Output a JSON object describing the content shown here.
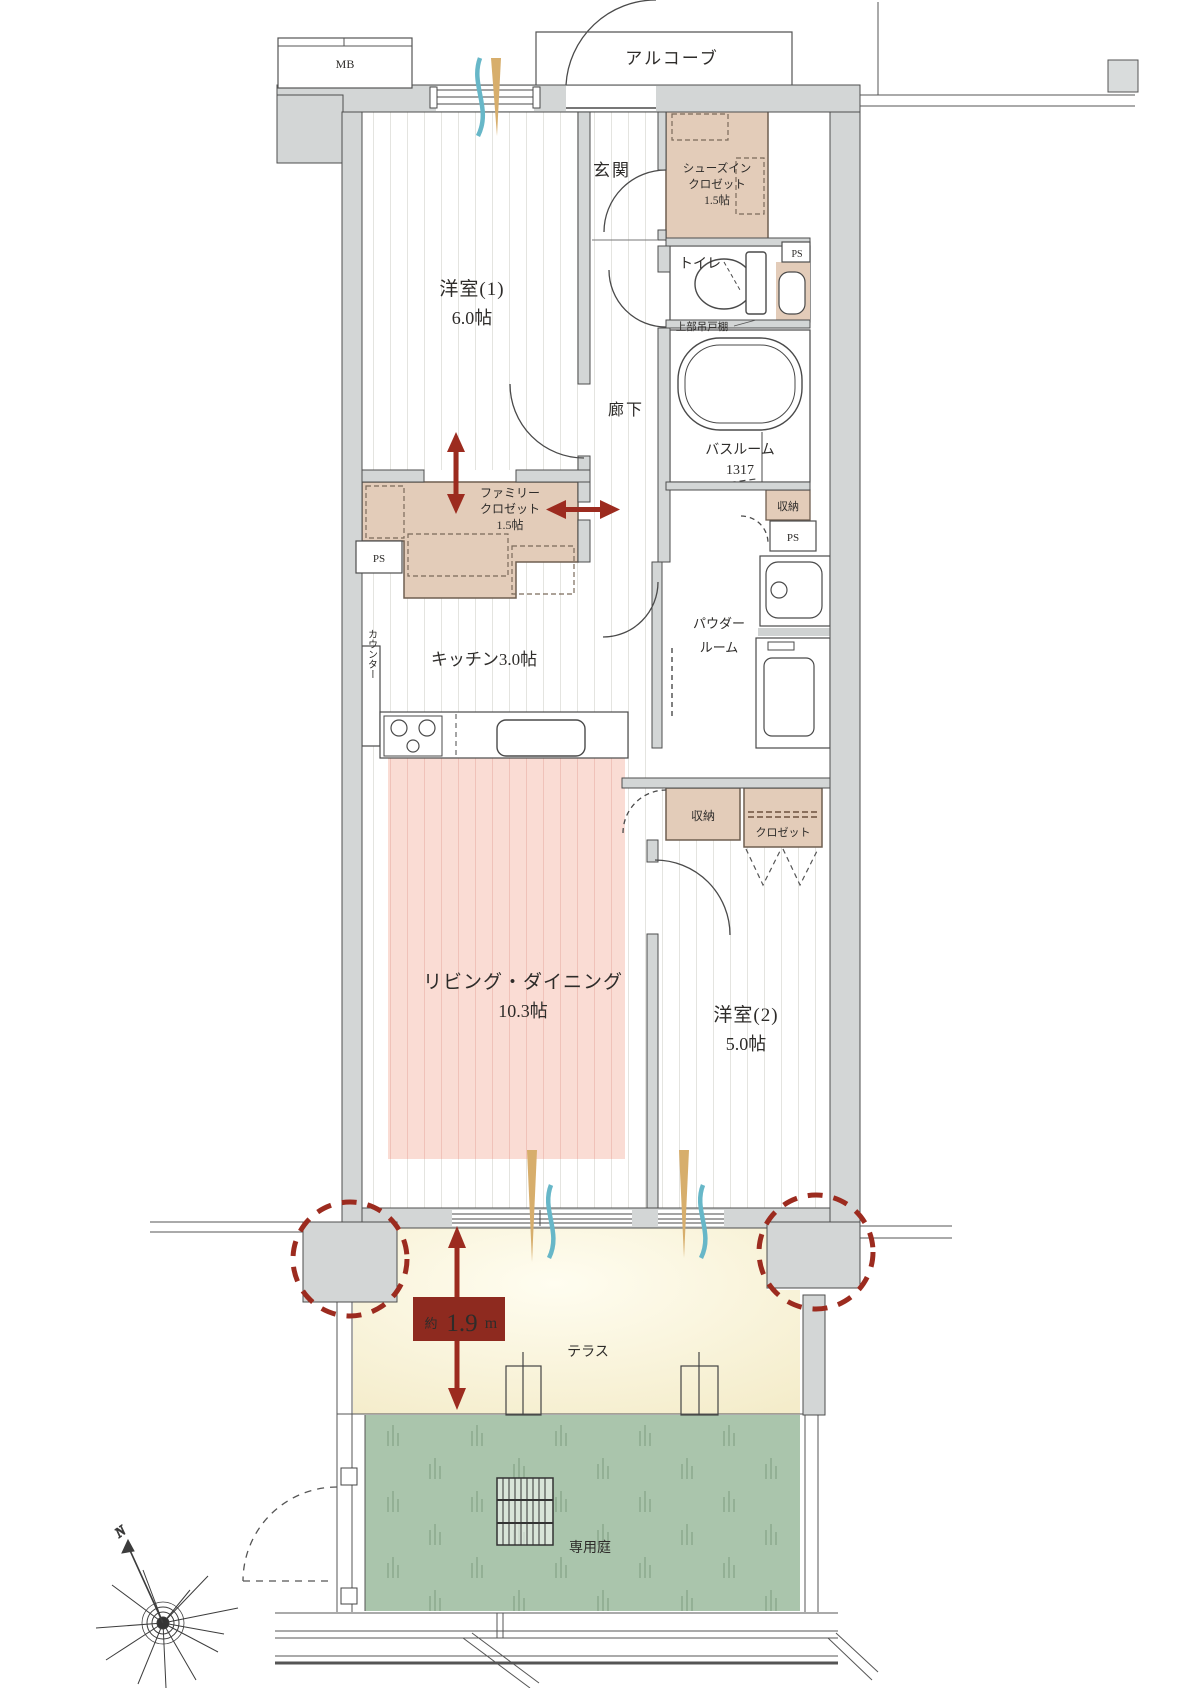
{
  "fp": {
    "mb": "MB",
    "alcove": "アルコーブ",
    "entrance": "玄関",
    "north": "N",
    "ps": "PS",
    "storage": "収納",
    "closet": "クロゼット",
    "hallway": "廊下",
    "garden": "専用庭",
    "sic": {
      "l1": "シューズイン",
      "l2": "クロゼット",
      "size": "1.5帖"
    },
    "wr1": {
      "name": "洋室(1)",
      "size": "6.0帖"
    },
    "toilet": {
      "name": "トイレ",
      "shelf": "上部吊戸棚"
    },
    "bath": {
      "name": "バスルーム",
      "size": "1317"
    },
    "fc": {
      "l1": "ファミリー",
      "l2": "クロゼット",
      "size": "1.5帖"
    },
    "kitchen": {
      "name": "キッチン3.0帖",
      "counter": "カウンター"
    },
    "powder": {
      "l1": "パウダー",
      "l2": "ルーム"
    },
    "ld": {
      "name": "リビング・ダイニング",
      "size": "10.3帖"
    },
    "wr2": {
      "name": "洋室(2)",
      "size": "5.0帖"
    },
    "terrace": {
      "name": "テラス",
      "d_prefix": "約",
      "d_value": "1.9",
      "d_unit": "m"
    }
  },
  "colors": {
    "wall_fill": "#d3d6d6",
    "wall_line": "#4e4e4e",
    "closet_fill": "#e3ccb9",
    "ld_highlight": "#fadcd4",
    "terrace_fill": "#f8f2d8",
    "garden_fill": "#aac5ac",
    "accent_red": "#9c2b1f",
    "airflow_blue": "#67b7c8",
    "airflow_tan": "#d7ae6c"
  }
}
